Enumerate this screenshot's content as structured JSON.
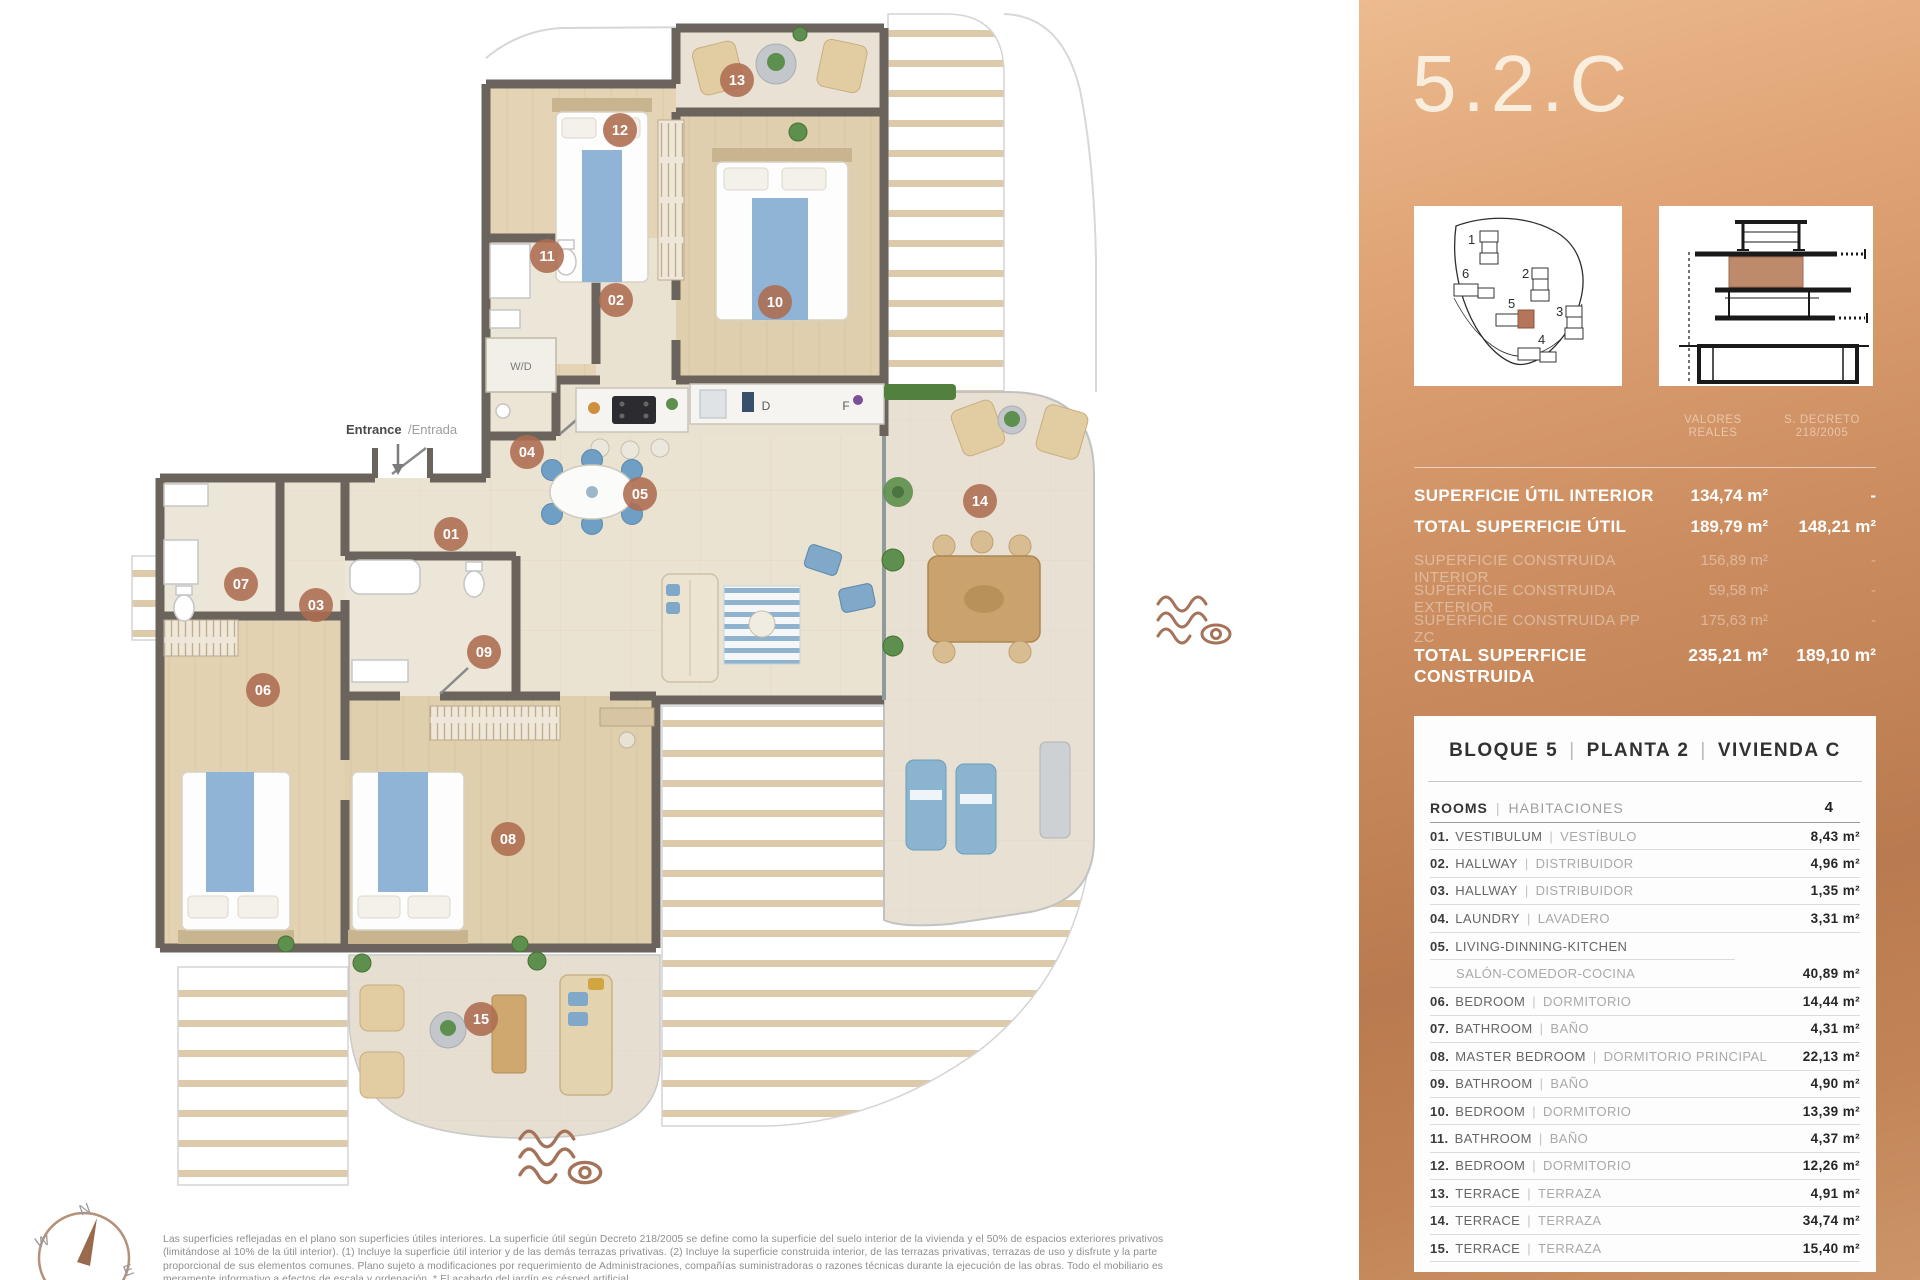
{
  "title": "5.2.C",
  "misc": {
    "pipe": "|"
  },
  "colors": {
    "copper_light": "#ecbb8f",
    "copper_dark": "#ba7a4f",
    "badge": "#ad6c50",
    "wall": "#6a645c",
    "accent_brown": "#a5735a",
    "bed_blue": "#8fb4d6"
  },
  "panel": {
    "surface_table": {
      "col1_header": [
        "VALORES",
        "REALES"
      ],
      "col2_header": [
        "S. DECRETO",
        "218/2005"
      ],
      "rows": [
        {
          "label": "SUPERFICIE ÚTIL INTERIOR",
          "v1": "134,74 m²",
          "v2": "-"
        },
        {
          "label": "TOTAL SUPERFICIE ÚTIL",
          "v1": "189,79 m²",
          "v2": "148,21 m²"
        },
        {
          "label": "SUPERFICIE CONSTRUIDA INTERIOR",
          "v1": "156,89 m²",
          "v2": "-"
        },
        {
          "label": "SUPERFICIE CONSTRUIDA EXTERIOR",
          "v1": "59,58 m²",
          "v2": "-"
        },
        {
          "label": "SUPERFICIE CONSTRUIDA PP ZC",
          "v1": "175,63 m²",
          "v2": "-"
        },
        {
          "label": "TOTAL SUPERFICIE CONSTRUIDA",
          "v1": "235,21 m²",
          "v2": "189,10 m²"
        }
      ]
    },
    "siteplan_labels": [
      "1",
      "2",
      "3",
      "4",
      "5",
      "6"
    ],
    "card": {
      "header": {
        "block": "BLOQUE 5",
        "floor": "PLANTA 2",
        "unit": "VIVIENDA C"
      },
      "rooms_header": {
        "en": "ROOMS",
        "es": "HABITACIONES",
        "count": "4"
      },
      "rows": [
        {
          "num": "01.",
          "en": "VESTIBULUM",
          "es": "VESTÍBULO",
          "area": "8,43 m²"
        },
        {
          "num": "02.",
          "en": "HALLWAY",
          "es": "DISTRIBUIDOR",
          "area": "4,96 m²"
        },
        {
          "num": "03.",
          "en": "HALLWAY",
          "es": "DISTRIBUIDOR",
          "area": "1,35 m²"
        },
        {
          "num": "04.",
          "en": "LAUNDRY",
          "es": "LAVADERO",
          "area": "3,31 m²"
        },
        {
          "num": "05.",
          "en": "LIVING-DINNING-KITCHEN",
          "es": "SALÓN-COMEDOR-COCINA",
          "area": "40,89 m²"
        },
        {
          "num": "06.",
          "en": "BEDROOM",
          "es": "DORMITORIO",
          "area": "14,44 m²"
        },
        {
          "num": "07.",
          "en": "BATHROOM",
          "es": "BAÑO",
          "area": "4,31 m²"
        },
        {
          "num": "08.",
          "en": "MASTER BEDROOM",
          "es": "DORMITORIO PRINCIPAL",
          "area": "22,13 m²"
        },
        {
          "num": "09.",
          "en": "BATHROOM",
          "es": "BAÑO",
          "area": "4,90 m²"
        },
        {
          "num": "10.",
          "en": "BEDROOM",
          "es": "DORMITORIO",
          "area": "13,39 m²"
        },
        {
          "num": "11.",
          "en": "BATHROOM",
          "es": "BAÑO",
          "area": "4,37 m²"
        },
        {
          "num": "12.",
          "en": "BEDROOM",
          "es": "DORMITORIO",
          "area": "12,26 m²"
        },
        {
          "num": "13.",
          "en": "TERRACE",
          "es": "TERRAZA",
          "area": "4,91 m²"
        },
        {
          "num": "14.",
          "en": "TERRACE",
          "es": "TERRAZA",
          "area": "34,74 m²"
        },
        {
          "num": "15.",
          "en": "TERRACE",
          "es": "TERRAZA",
          "area": "15,40 m²"
        }
      ]
    }
  },
  "plan": {
    "labels": {
      "entrance_en": "Entrance",
      "entrance_es": "/Entrada",
      "wd": "W/D",
      "d": "D",
      "f": "F"
    },
    "badges": [
      "01",
      "02",
      "03",
      "04",
      "05",
      "06",
      "07",
      "08",
      "09",
      "10",
      "11",
      "12",
      "13",
      "14",
      "15"
    ],
    "compass": {
      "n": "N",
      "e": "E",
      "s": "S",
      "w": "W"
    }
  },
  "disclaimer": [
    "Las superficies reflejadas en el plano son superficies útiles interiores. La superficie útil según Decreto 218/2005 se define como la superficie del suelo interior de la vivienda y el 50% de espacios exteriores privativos",
    "(limitándose al 10% de la útil interior). (1) Incluye la superficie útil interior y de las demás terrazas privativas. (2) Incluye la superficie construida interior, de las terrazas privativas, terrazas de uso y disfrute y la parte",
    "proporcional de sus elementos comunes. Plano sujeto a modificaciones por requerimiento de Administraciones, compañías suministradoras o razones técnicas durante la ejecución de las obras. Todo el mobiliario es",
    "meramente informativo a efectos de escala y ordenación. * El acabado del jardín es césped artificial."
  ]
}
